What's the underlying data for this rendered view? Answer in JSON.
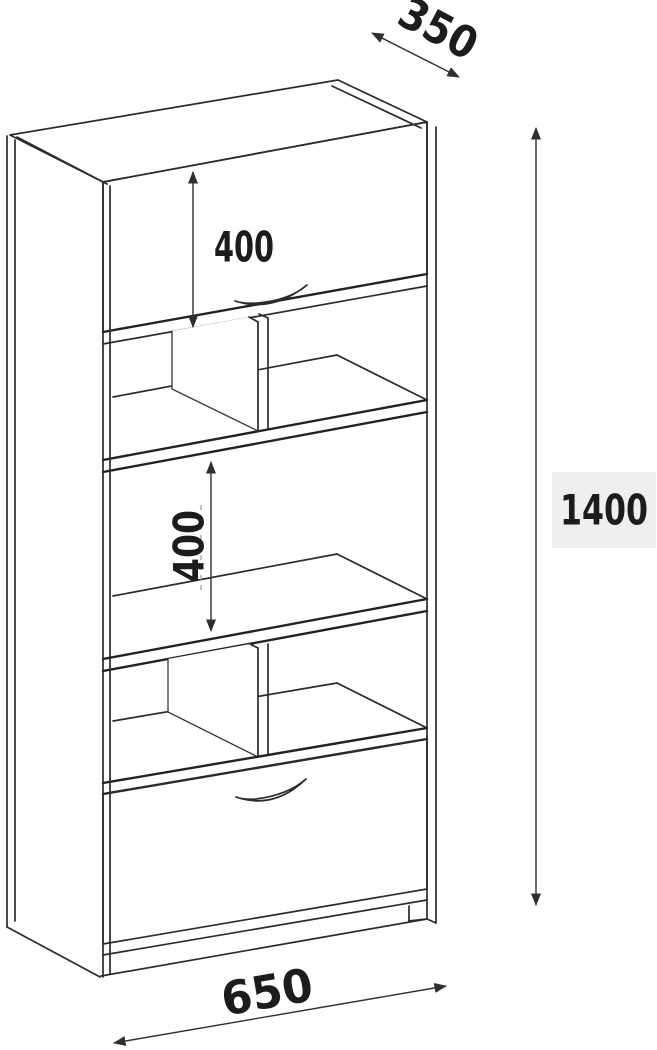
{
  "diagram": {
    "type": "furniture-dimension-drawing",
    "subject": "tall shelf cabinet with top flap door, open cubby compartments and bottom drawer",
    "dimension_labels": {
      "depth": "350",
      "top_door_height": "400",
      "middle_section_height": "400",
      "total_height": "1400",
      "width": "650"
    },
    "colors": {
      "line": "#2b2b2b",
      "dimension_line": "#2f2f2f",
      "text": "#1c1c1c",
      "height_label_bg": "#efefef",
      "background": "#ffffff"
    }
  }
}
